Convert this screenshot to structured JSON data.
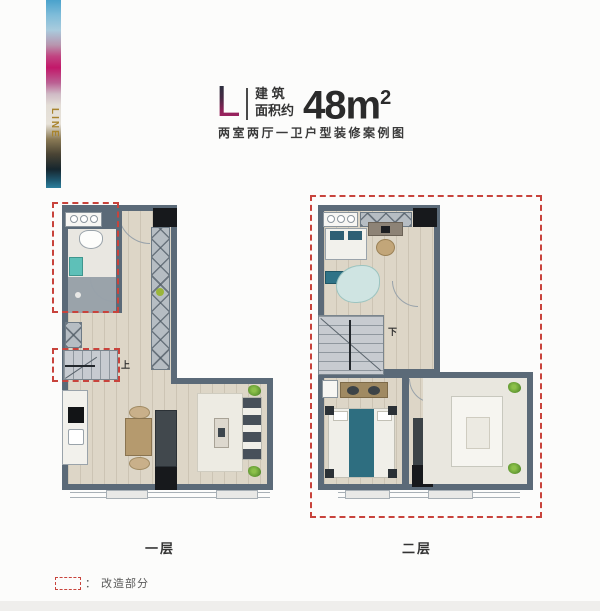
{
  "brand": {
    "vertical_text": "LINE"
  },
  "header": {
    "type_letter": "L",
    "area_label_line1": "建 筑",
    "area_label_line2": "面积约",
    "area_value": "48m",
    "area_superscript": "2",
    "subtitle": "两室两厅一卫户型装修案例图"
  },
  "floor1": {
    "label": "一层",
    "stair_mark": "上"
  },
  "floor2": {
    "label": "二层",
    "stair_mark": "下"
  },
  "legend": {
    "colon": "：",
    "label": "改造部分"
  },
  "colors": {
    "wall": "#5b6a78",
    "floor_wood": "#ddd6c7",
    "renovation_dashed": "#c8433c",
    "shaft_black": "#17191c",
    "accent_teal": "#2f7387",
    "sink_teal": "#5ec0b8",
    "brand_gold": "#a8842e",
    "brand_magenta": "#c2186a",
    "brand_blue": "#4aa2cc",
    "title_text": "#2b2b2b"
  }
}
